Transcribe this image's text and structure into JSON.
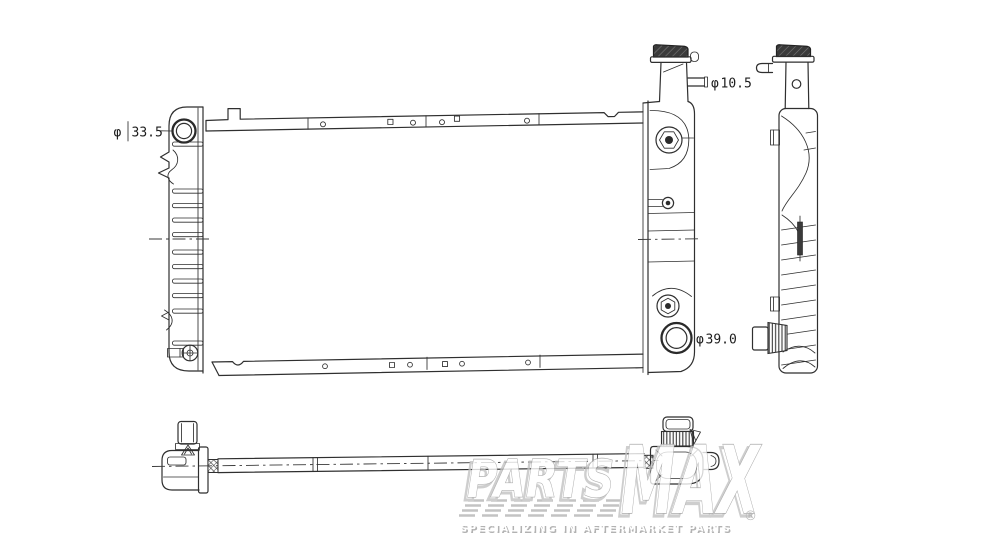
{
  "drawing": {
    "dimension_labels": {
      "inlet": {
        "symbol": "φ",
        "value": "33.5"
      },
      "overflow": {
        "symbol": "φ",
        "value": "10.5"
      },
      "outlet": {
        "symbol": "φ",
        "value": "39.0"
      }
    }
  },
  "watermark": {
    "brand_first": "PARTS",
    "brand_second": "MAX",
    "registered": "®",
    "tagline": "SPECIALIZING IN AFTERMARKET PARTS"
  }
}
